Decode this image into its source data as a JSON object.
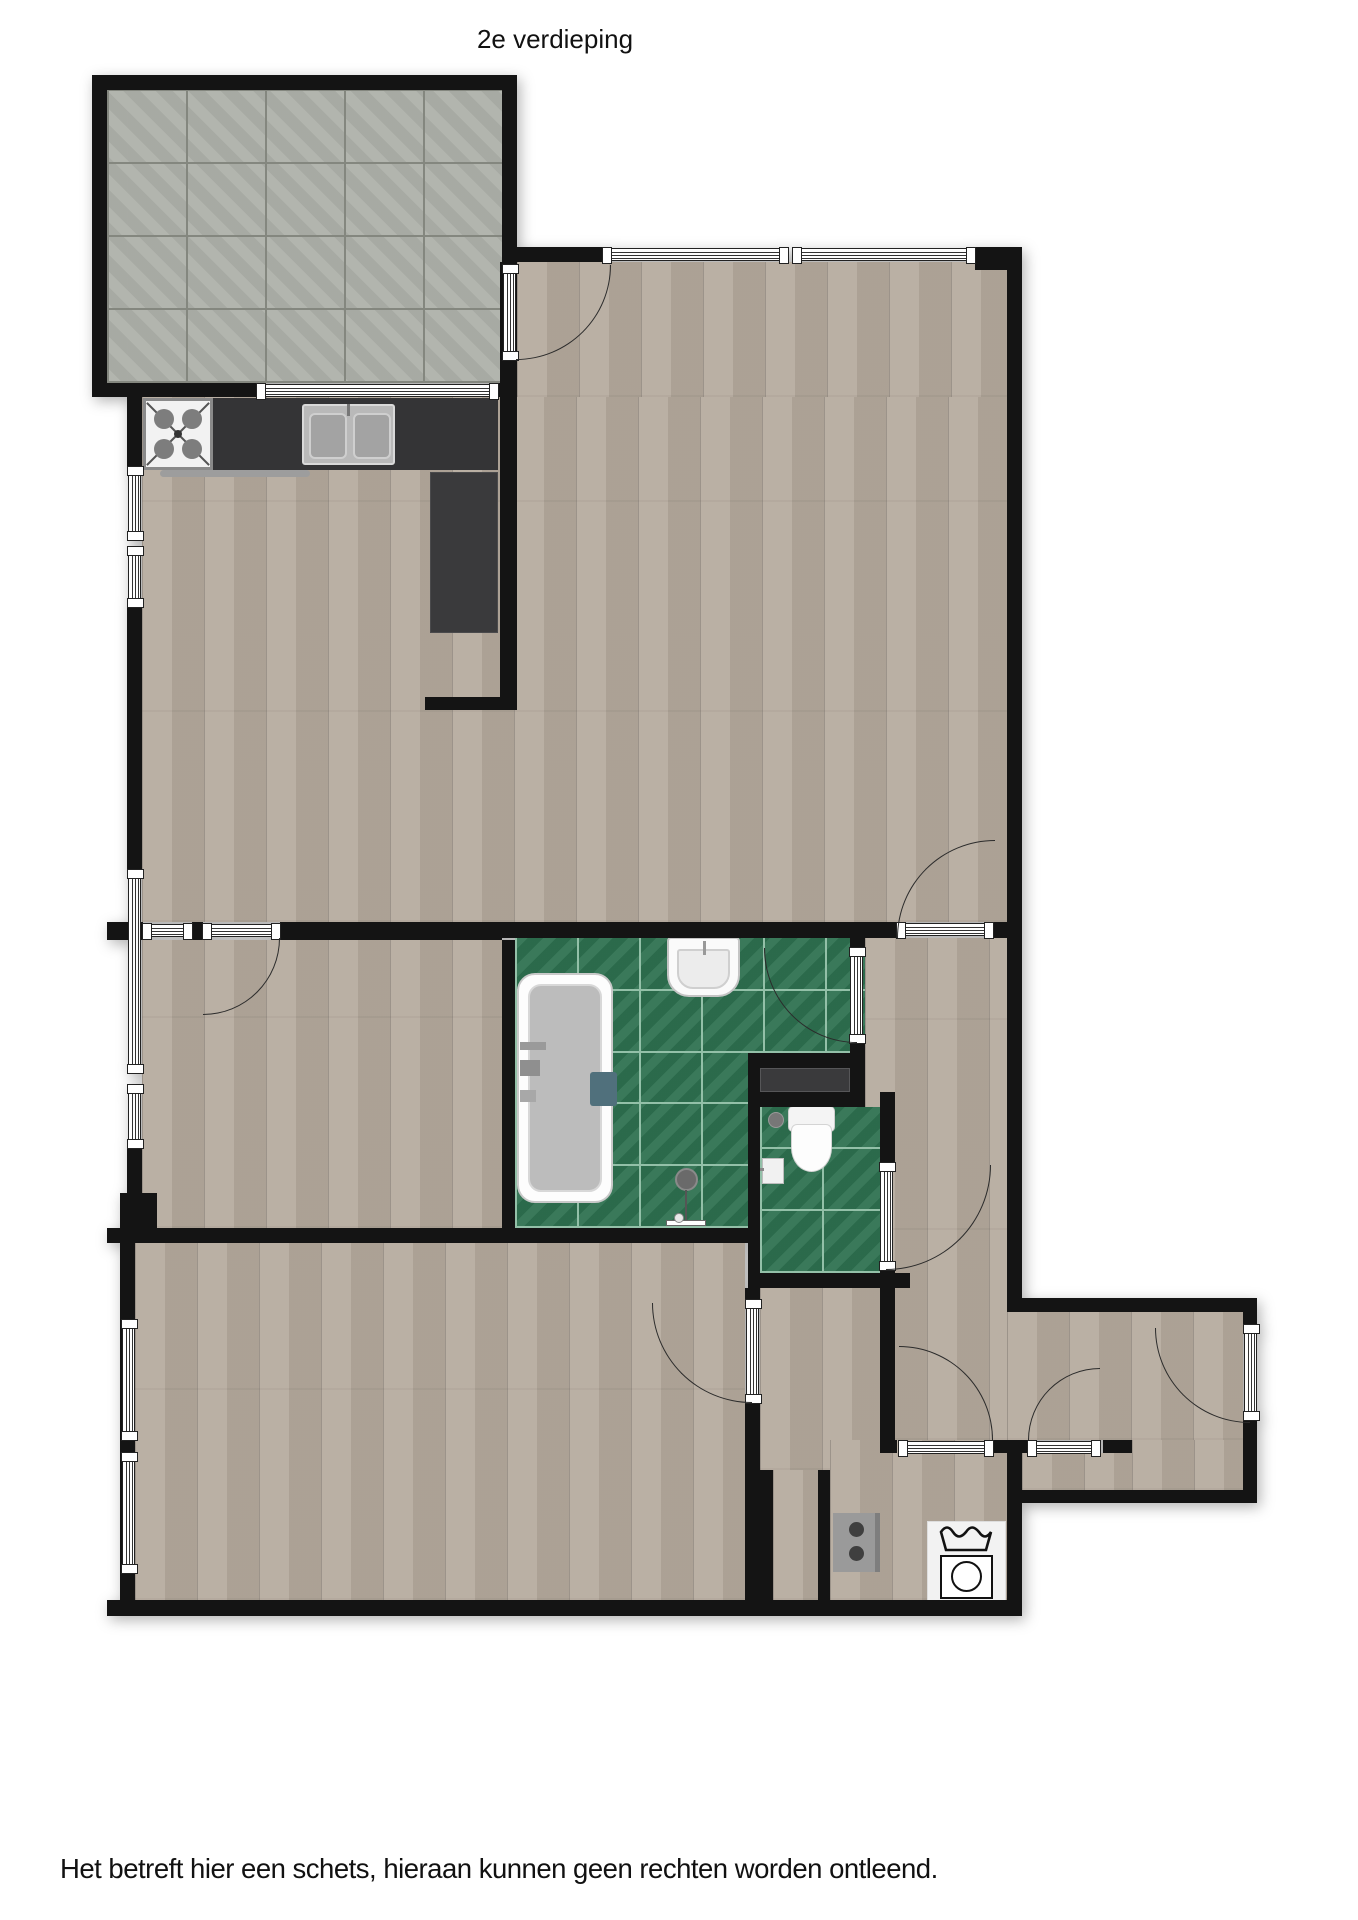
{
  "title": "2e verdieping",
  "disclaimer": "Het betreft hier een schets, hieraan kunnen geen rechten worden ontleend.",
  "colors": {
    "wall": "#141414",
    "wood": "#b5aa9d",
    "terrace": "#aeb1aa",
    "terrace-line": "#84877f",
    "tile": "#2e7150",
    "tile-line": "#93c0a8",
    "counter": "#343436",
    "fixture": "#9a9a9a",
    "arc": "#2b2b2b"
  },
  "icons": {
    "stove": "gas-hob-4-burners",
    "kitchen_sink": "double-basin-sink",
    "bathtub": "bathtub-top-view",
    "washbasin": "bathroom-sink",
    "shower": "handheld-shower",
    "toilet": "toilet-top-view",
    "corner_sink": "small-corner-sink",
    "washing_machine": "washing-machine-laundry-symbol",
    "boiler": "appliance-two-knobs",
    "window": "triple-line-window-symbol",
    "door": "door-leaf-with-swing-arc"
  }
}
